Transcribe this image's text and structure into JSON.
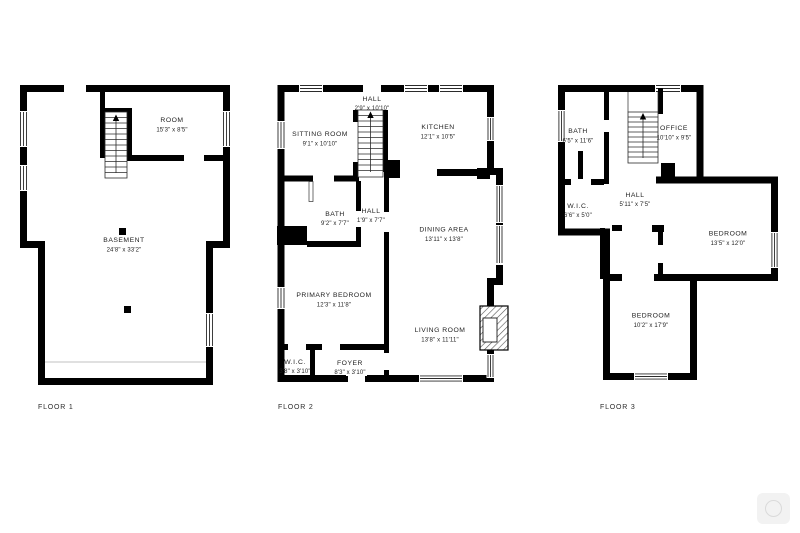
{
  "image_type": "floor-plan",
  "colors": {
    "walls": "#000000",
    "text": "#1f1f1f",
    "background": "#ffffff"
  },
  "floors": [
    {
      "label": "FLOOR 1",
      "rooms": [
        {
          "name": "ROOM",
          "dims": "15'3\" x 8'5\""
        },
        {
          "name": "BASEMENT",
          "dims": "24'8\" x 33'2\""
        }
      ]
    },
    {
      "label": "FLOOR 2",
      "rooms": [
        {
          "name": "HALL",
          "dims": "2'9\" x 10'10\""
        },
        {
          "name": "SITTING ROOM",
          "dims": "9'1\" x 10'10\""
        },
        {
          "name": "KITCHEN",
          "dims": "12'1\" x 10'5\""
        },
        {
          "name": "BATH",
          "dims": "9'2\" x 7'7\""
        },
        {
          "name": "HALL",
          "dims": "1'9\" x 7'7\""
        },
        {
          "name": "DINING AREA",
          "dims": "13'11\" x 13'8\""
        },
        {
          "name": "PRIMARY BEDROOM",
          "dims": "12'3\" x 11'8\""
        },
        {
          "name": "LIVING ROOM",
          "dims": "13'8\" x 11'11\""
        },
        {
          "name": "W.I.C.",
          "dims": "3'8\" x 3'10\""
        },
        {
          "name": "FOYER",
          "dims": "8'3\" x 3'10\""
        }
      ]
    },
    {
      "label": "FLOOR 3",
      "rooms": [
        {
          "name": "BATH",
          "dims": "6'5\" x 11'6\""
        },
        {
          "name": "OFFICE",
          "dims": "10'10\" x 9'5\""
        },
        {
          "name": "W.I.C.",
          "dims": "6'6\" x 5'0\""
        },
        {
          "name": "HALL",
          "dims": "5'11\" x 7'5\""
        },
        {
          "name": "BEDROOM",
          "dims": "13'5\" x 12'0\""
        },
        {
          "name": "BEDROOM",
          "dims": "10'2\" x 17'9\""
        }
      ]
    }
  ]
}
